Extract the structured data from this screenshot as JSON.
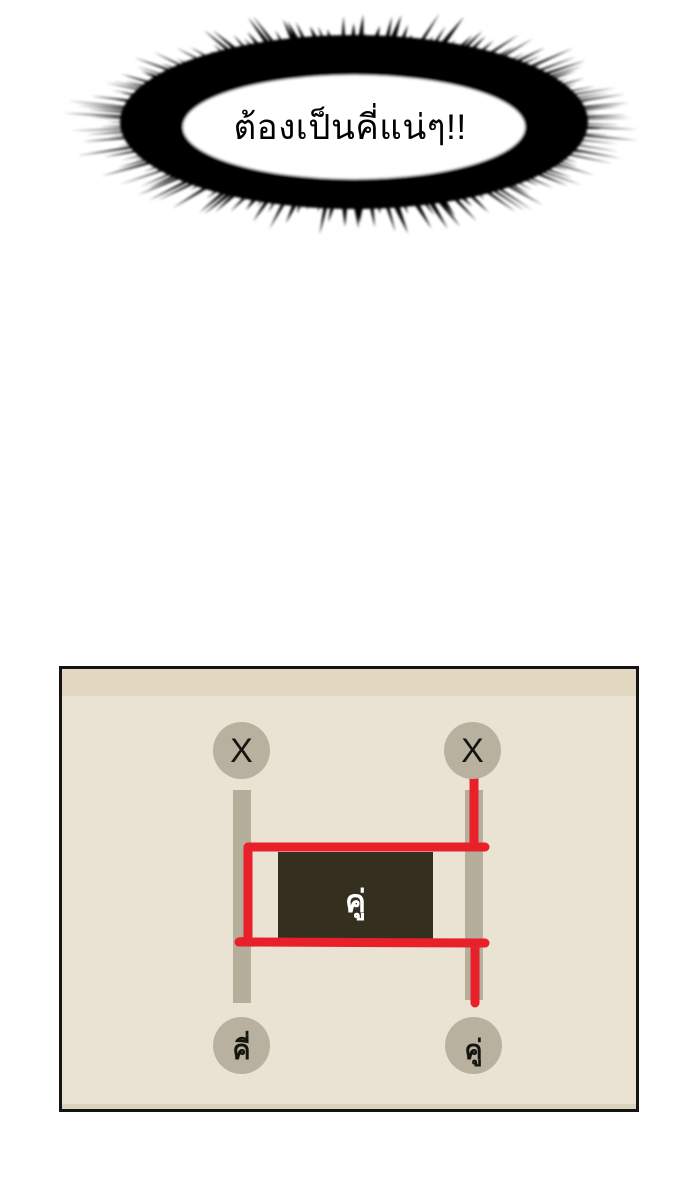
{
  "speech_bubble": {
    "text": "ต้องเป็นคี่แน่ๆ!!"
  },
  "panel": {
    "nodes": {
      "top_left": "X",
      "top_right": "X",
      "bottom_left": "คี่",
      "bottom_right": "คู่"
    },
    "center_box_label": "คู่",
    "colors": {
      "panel_bg": "#EAE3D3",
      "top_band": "#E2D8C2",
      "node_fill": "#B8B19F",
      "rail_fill": "#B5AE9B",
      "box_fill": "#352F20",
      "path_red": "#E8202A"
    }
  }
}
